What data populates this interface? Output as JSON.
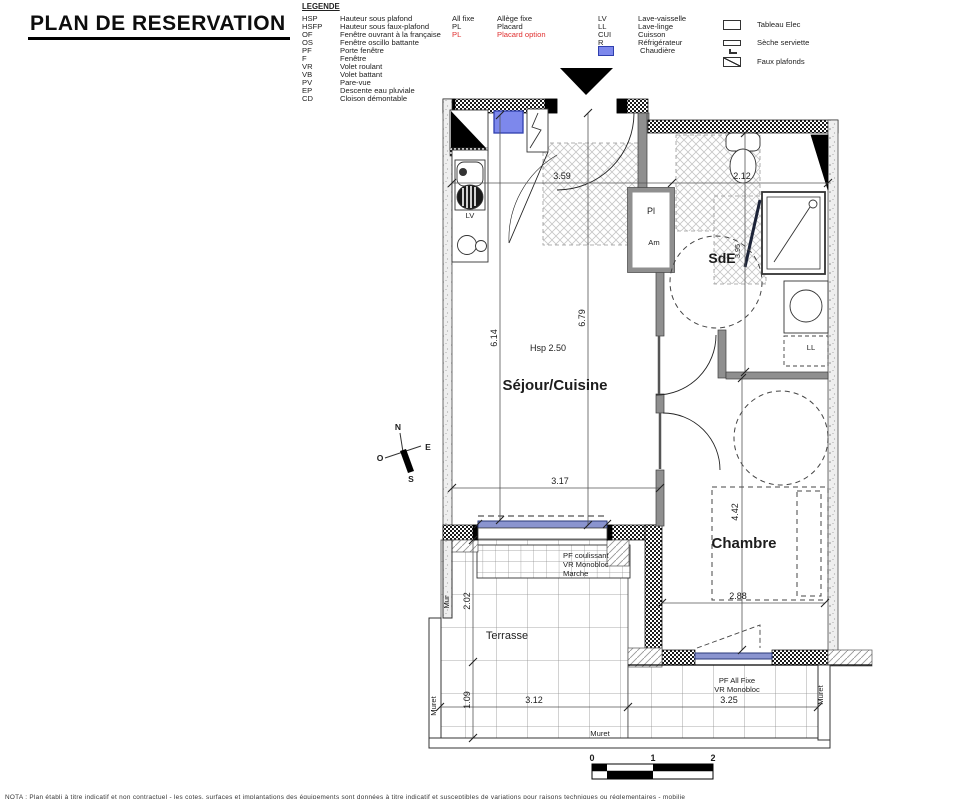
{
  "title": "PLAN DE RESERVATION",
  "legend": {
    "heading": "LEGENDE",
    "col1": [
      {
        "abbr": "HSP",
        "label": "Hauteur sous plafond"
      },
      {
        "abbr": "HSFP",
        "label": "Hauteur sous faux-plafond"
      },
      {
        "abbr": "OF",
        "label": "Fenêtre ouvrant à la française"
      },
      {
        "abbr": "OS",
        "label": "Fenêtre oscillo battante"
      },
      {
        "abbr": "PF",
        "label": "Porte fenêtre"
      },
      {
        "abbr": "F",
        "label": "Fenêtre"
      },
      {
        "abbr": "VR",
        "label": "Volet roulant"
      },
      {
        "abbr": "VB",
        "label": "Volet battant"
      },
      {
        "abbr": "PV",
        "label": "Pare-vue"
      },
      {
        "abbr": "EP",
        "label": "Descente eau pluviale"
      },
      {
        "abbr": "CD",
        "label": "Cloison démontable"
      }
    ],
    "col2": [
      {
        "abbr": "All fixe",
        "label": "Allège fixe"
      },
      {
        "abbr": "PL",
        "label": "Placard"
      },
      {
        "abbr": "PL",
        "label": "Placard option"
      }
    ],
    "col3": [
      {
        "abbr": "LV",
        "label": "Lave-vaisselle"
      },
      {
        "abbr": "LL",
        "label": "Lave-linge"
      },
      {
        "abbr": "CUI",
        "label": "Cuisson"
      },
      {
        "abbr": "R",
        "label": "Réfrigérateur"
      },
      {
        "abbr": "",
        "label": "Chaudière"
      }
    ],
    "col4": [
      {
        "icon": "tableau-elec",
        "label": "Tableau Elec"
      },
      {
        "icon": "seche-serviette",
        "label": "Sèche serviette"
      },
      {
        "icon": "faux-plafonds",
        "label": "Faux plafonds"
      }
    ]
  },
  "plan": {
    "rooms": {
      "sejour": "Séjour/Cuisine",
      "chambre": "Chambre",
      "sde": "SdE",
      "terrasse": "Terrasse"
    },
    "labels": {
      "pl": "Pl",
      "am": "Am",
      "lv": "LV",
      "ll": "LL",
      "mur": "Mur",
      "muret": "Muret",
      "hsp": "Hsp 2.50"
    },
    "dims": {
      "entree": "3.59",
      "wc": "2.12",
      "sejour_l": "6.14",
      "sejour_c": "6.79",
      "sde": "3.95",
      "sejour_w": "3.17",
      "chambre_w": "2.88",
      "chambre_h": "4.42",
      "terrasse_h": "2.02",
      "muret_h": "1.09",
      "terrasse_w": "3.12",
      "terrasse_w2": "3.25"
    },
    "notes": {
      "slider1": "PF coulissant",
      "slider2": "VR Monobloc",
      "slider3": "Marche",
      "fixed1": "PF All Fixe",
      "fixed2": "VR Monobloc"
    },
    "compass": {
      "n": "N",
      "e": "E",
      "s": "S",
      "o": "O"
    }
  },
  "scalebar": {
    "t0": "0",
    "t1": "1",
    "t2": "2"
  },
  "colors": {
    "red_text": "#e03030",
    "glazing_blue": "#8a94cf",
    "chaudiere_blue": "#7d88ec"
  },
  "footnote": "NOTA : Plan établi à titre indicatif et non contractuel - les cotes, surfaces et implantations des équipements sont données à titre indicatif et susceptibles de variations pour raisons techniques ou réglementaires - mobilier non contractuel"
}
